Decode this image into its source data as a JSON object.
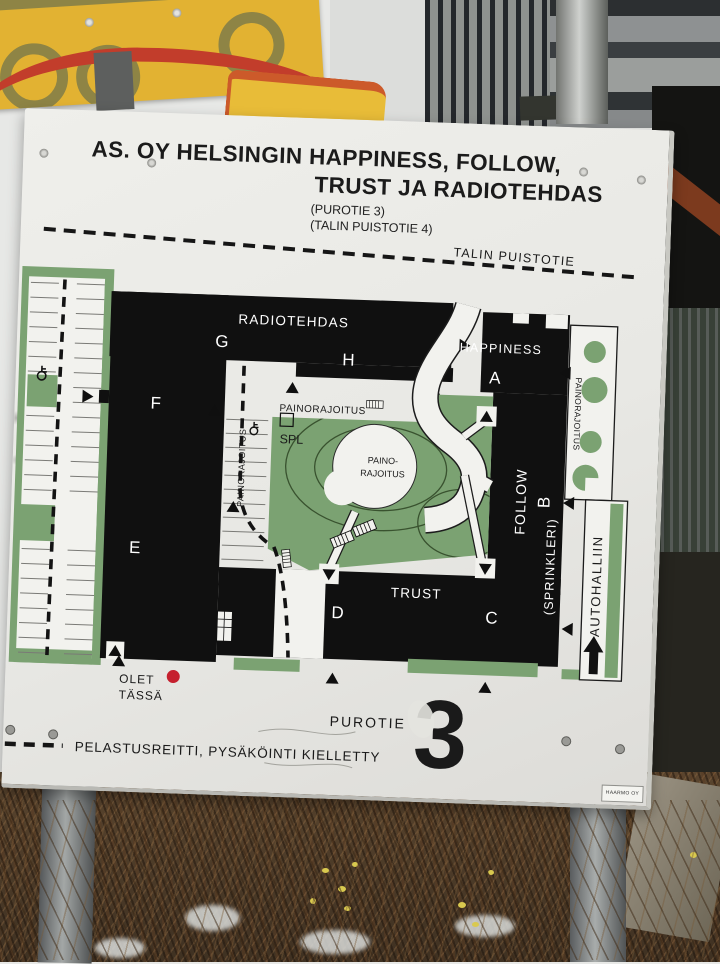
{
  "sign": {
    "title_line1": "AS. OY HELSINGIN HAPPINESS, FOLLOW,",
    "title_line2": "TRUST JA RADIOTEHDAS",
    "address1": "(PUROTIE 3)",
    "address2": "(TALIN PUISTOTIE 4)",
    "street_top": "TALIN PUISTOTIE",
    "street_bottom": "PUROTIE",
    "plot_number": "3",
    "you_here1": "OLET",
    "you_here2": "TÄSSÄ",
    "legend": "PELASTUSREITTI, PYSÄKÖINTI KIELLETTY",
    "maker": "HAARMO OY"
  },
  "map": {
    "radiotehdas": "RADIOTEHDAS",
    "g": "G",
    "h": "H",
    "happiness": "HAPPINESS",
    "a": "A",
    "follow": "FOLLOW",
    "b": "B",
    "sprinkleri": "(SPRINKLERI)",
    "trust": "TRUST",
    "d": "D",
    "c": "C",
    "f": "F",
    "e": "E",
    "painorajoitus": "PAINORAJOITUS",
    "paino1": "PAINO-",
    "paino2": "RAJOITUS",
    "spl": "SPL",
    "autohalliin": "AUTOHALLIIN"
  },
  "colors": {
    "map_green": "#7ba272",
    "building_black": "#101010",
    "marker_red": "#c5202e",
    "sign_bg": "#e9e9e5",
    "warning_yellow": "#e2b232",
    "warning_red": "#c23d2b"
  }
}
